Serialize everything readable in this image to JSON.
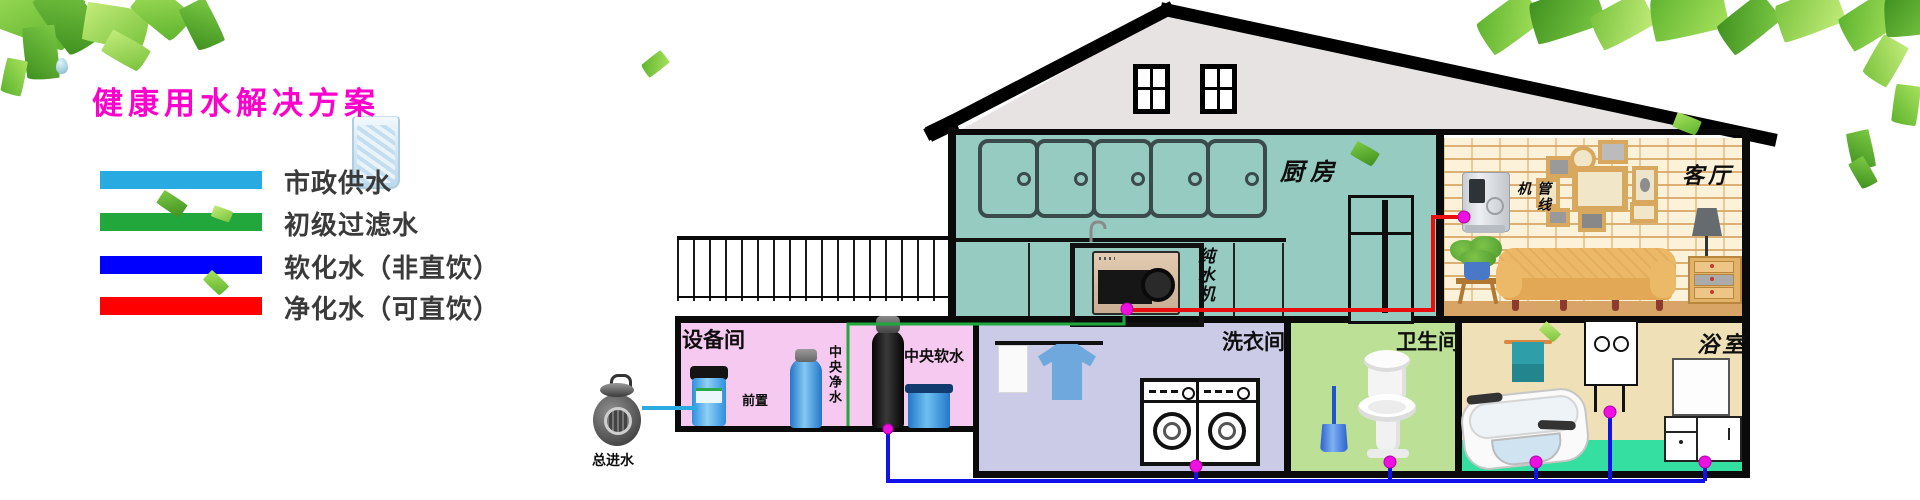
{
  "title": {
    "text": "健康用水解决方案",
    "color": "#FF00CC"
  },
  "legend": {
    "items": [
      {
        "label": "市政供水",
        "color": "#29ABE2"
      },
      {
        "label": "初级过滤水",
        "color": "#22A73C"
      },
      {
        "label": "软化水（非直饮）",
        "color": "#0000FE"
      },
      {
        "label": "净化水（可直饮）",
        "color": "#FE0000"
      }
    ]
  },
  "house": {
    "rooms": {
      "kitchen": {
        "label": "厨房",
        "wall_color": "#95CBC1"
      },
      "living": {
        "label": "客厅",
        "wall_color": "#FBF2D9"
      },
      "equipment": {
        "label": "设备间",
        "wall_color": "#F6C9F1"
      },
      "laundry": {
        "label": "洗衣间",
        "wall_color": "#CBCBE8"
      },
      "toilet": {
        "label": "卫生间",
        "wall_color": "#BCE096"
      },
      "bath": {
        "label": "浴室",
        "wall_color": "#F0E0B8",
        "floor_color": "#35DFA1"
      }
    },
    "equipment_labels": {
      "prefilter": "前置",
      "central_purifier": "中央净水",
      "central_softener": "中央软水",
      "ro_machine": "纯水机",
      "pipeline_machine": "管线机",
      "main_inlet": "总进水"
    },
    "pipe_colors": {
      "municipal": "#29ABE2",
      "filtered": "#1FA83C",
      "softened": "#1212E8",
      "purified": "#E80E0E",
      "joint_dot": "#EE10E0"
    }
  }
}
